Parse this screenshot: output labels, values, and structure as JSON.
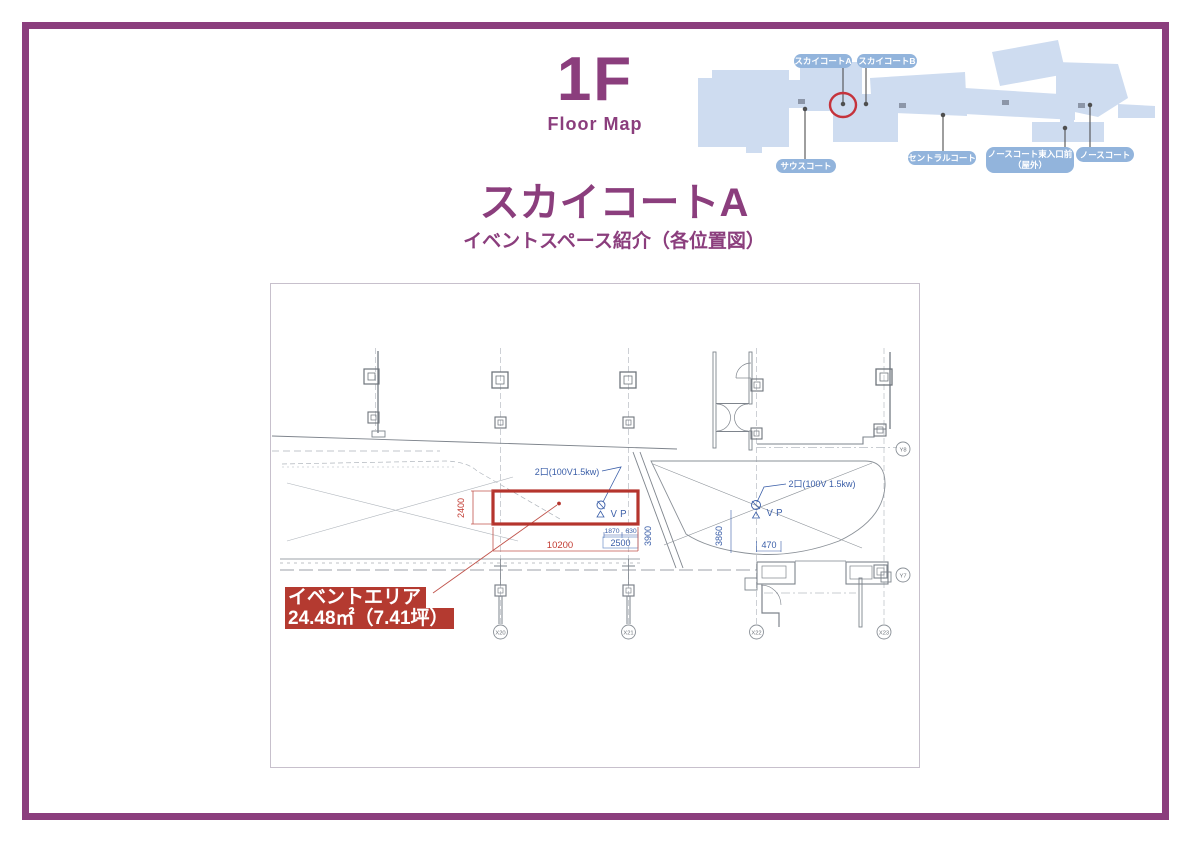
{
  "header": {
    "floor_number": "1F",
    "floor_caption": "Floor Map"
  },
  "heading": {
    "title": "スカイコートA",
    "subtitle": "イベントスペース紹介（各位置図）"
  },
  "overview_map": {
    "labels": [
      {
        "text": "スカイコートA"
      },
      {
        "text": "スカイコートB"
      },
      {
        "text": "サウスコート"
      },
      {
        "text": "セントラルコート"
      },
      {
        "text": "ノースコート東入口前",
        "text2": "（屋外）"
      },
      {
        "text": "ノースコート"
      }
    ],
    "colors": {
      "pill": "#92B4DC",
      "map_fill": "#CEDCF0",
      "highlight_ring": "#C5333C"
    }
  },
  "plan": {
    "event_area": {
      "line1": "イベントエリア",
      "line2": "24.48㎡（7.41坪）"
    },
    "outlets": {
      "left": "2口(100V1.5kw)",
      "right": "2口(100V 1.5kw)"
    },
    "vp_label": "ＶＰ",
    "dims": {
      "w": "10200",
      "h": "2400",
      "seg1": "1870",
      "seg2": "630",
      "total": "2500",
      "v1": "3900",
      "v2": "3860",
      "v3": "470"
    },
    "grid_x": [
      "X20",
      "X21",
      "X22",
      "X23"
    ],
    "grid_y": [
      "Y8",
      "Y7"
    ],
    "colors": {
      "red": "#B5342D",
      "dim_red": "#C23B32",
      "blue": "#3A5EA8"
    }
  }
}
